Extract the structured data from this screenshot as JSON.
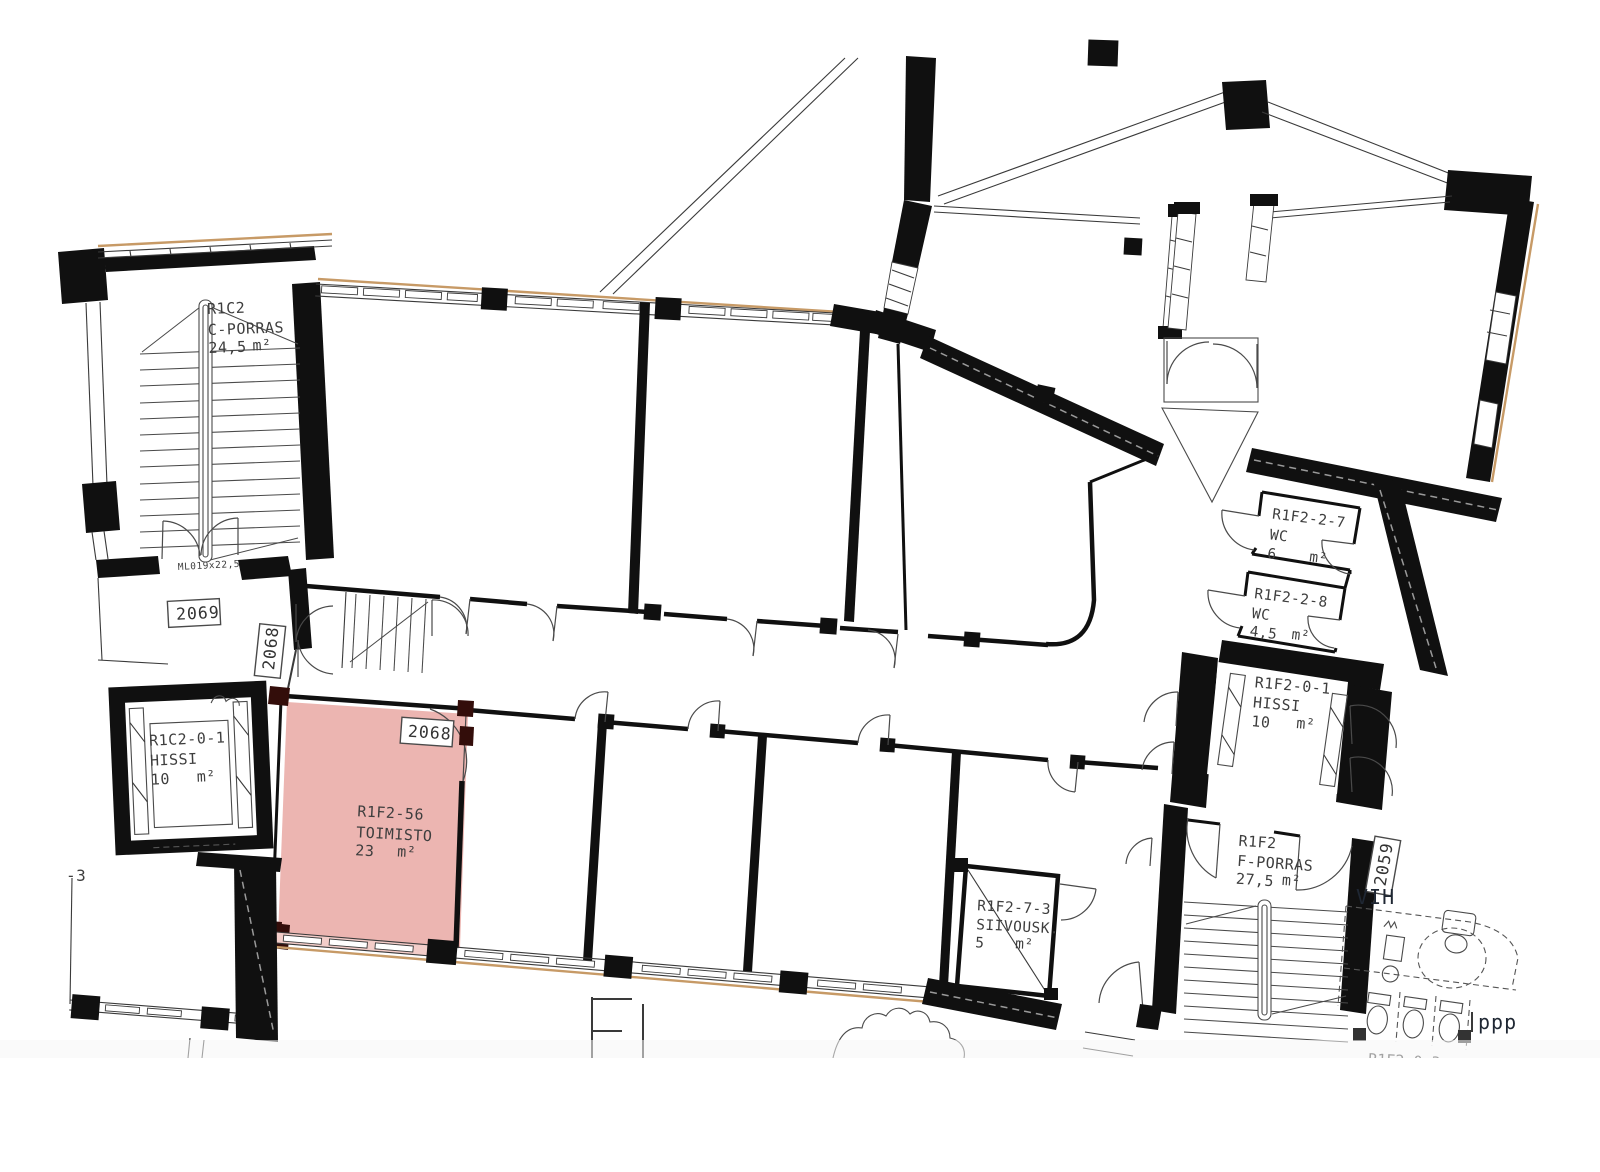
{
  "plan": {
    "colors": {
      "highlight": "#ecb5b1",
      "highlight_window": "#f3cdc9",
      "highlight_dark": "#330d0a",
      "accent": "#c79a66",
      "wall": "#101010",
      "text": "#3e3e3e"
    },
    "rooms": [
      {
        "key": "c_porras",
        "id": "R1C2",
        "name": "C-PORRAS",
        "area": "24,5",
        "unit": "m²"
      },
      {
        "key": "hissi_left",
        "id": "R1C2-0-1",
        "name": "HISSI",
        "area": "10",
        "unit": "m²"
      },
      {
        "key": "toimisto",
        "id": "R1F2-56",
        "name": "TOIMISTO",
        "area": "23",
        "unit": "m²"
      },
      {
        "key": "wc_7",
        "id": "R1F2-2-7",
        "name": "WC",
        "area": "6",
        "unit": "m²"
      },
      {
        "key": "wc_8",
        "id": "R1F2-2-8",
        "name": "WC",
        "area": "4,5",
        "unit": "m²"
      },
      {
        "key": "hissi_right",
        "id": "R1F2-0-1",
        "name": "HISSI",
        "area": "10",
        "unit": "m²"
      },
      {
        "key": "f_porras",
        "id": "R1F2",
        "name": "F-PORRAS",
        "area": "27,5",
        "unit": "m²"
      },
      {
        "key": "siivousk",
        "id": "R1F2-7-3",
        "name": "SIIVOUSK.",
        "area": "5",
        "unit": "m²"
      }
    ],
    "tags": {
      "stair_c_door": "2069",
      "corridor_door": "2068",
      "toimisto_door": "2068",
      "stair_f_door": "2059"
    },
    "annotations": {
      "door_code": "ML019x22,5",
      "level_mark": "-3",
      "wing_mark": "VIH",
      "partial_room": "R1F2-0-3",
      "site_mark": "ppp",
      "partial_letters": "El"
    }
  }
}
